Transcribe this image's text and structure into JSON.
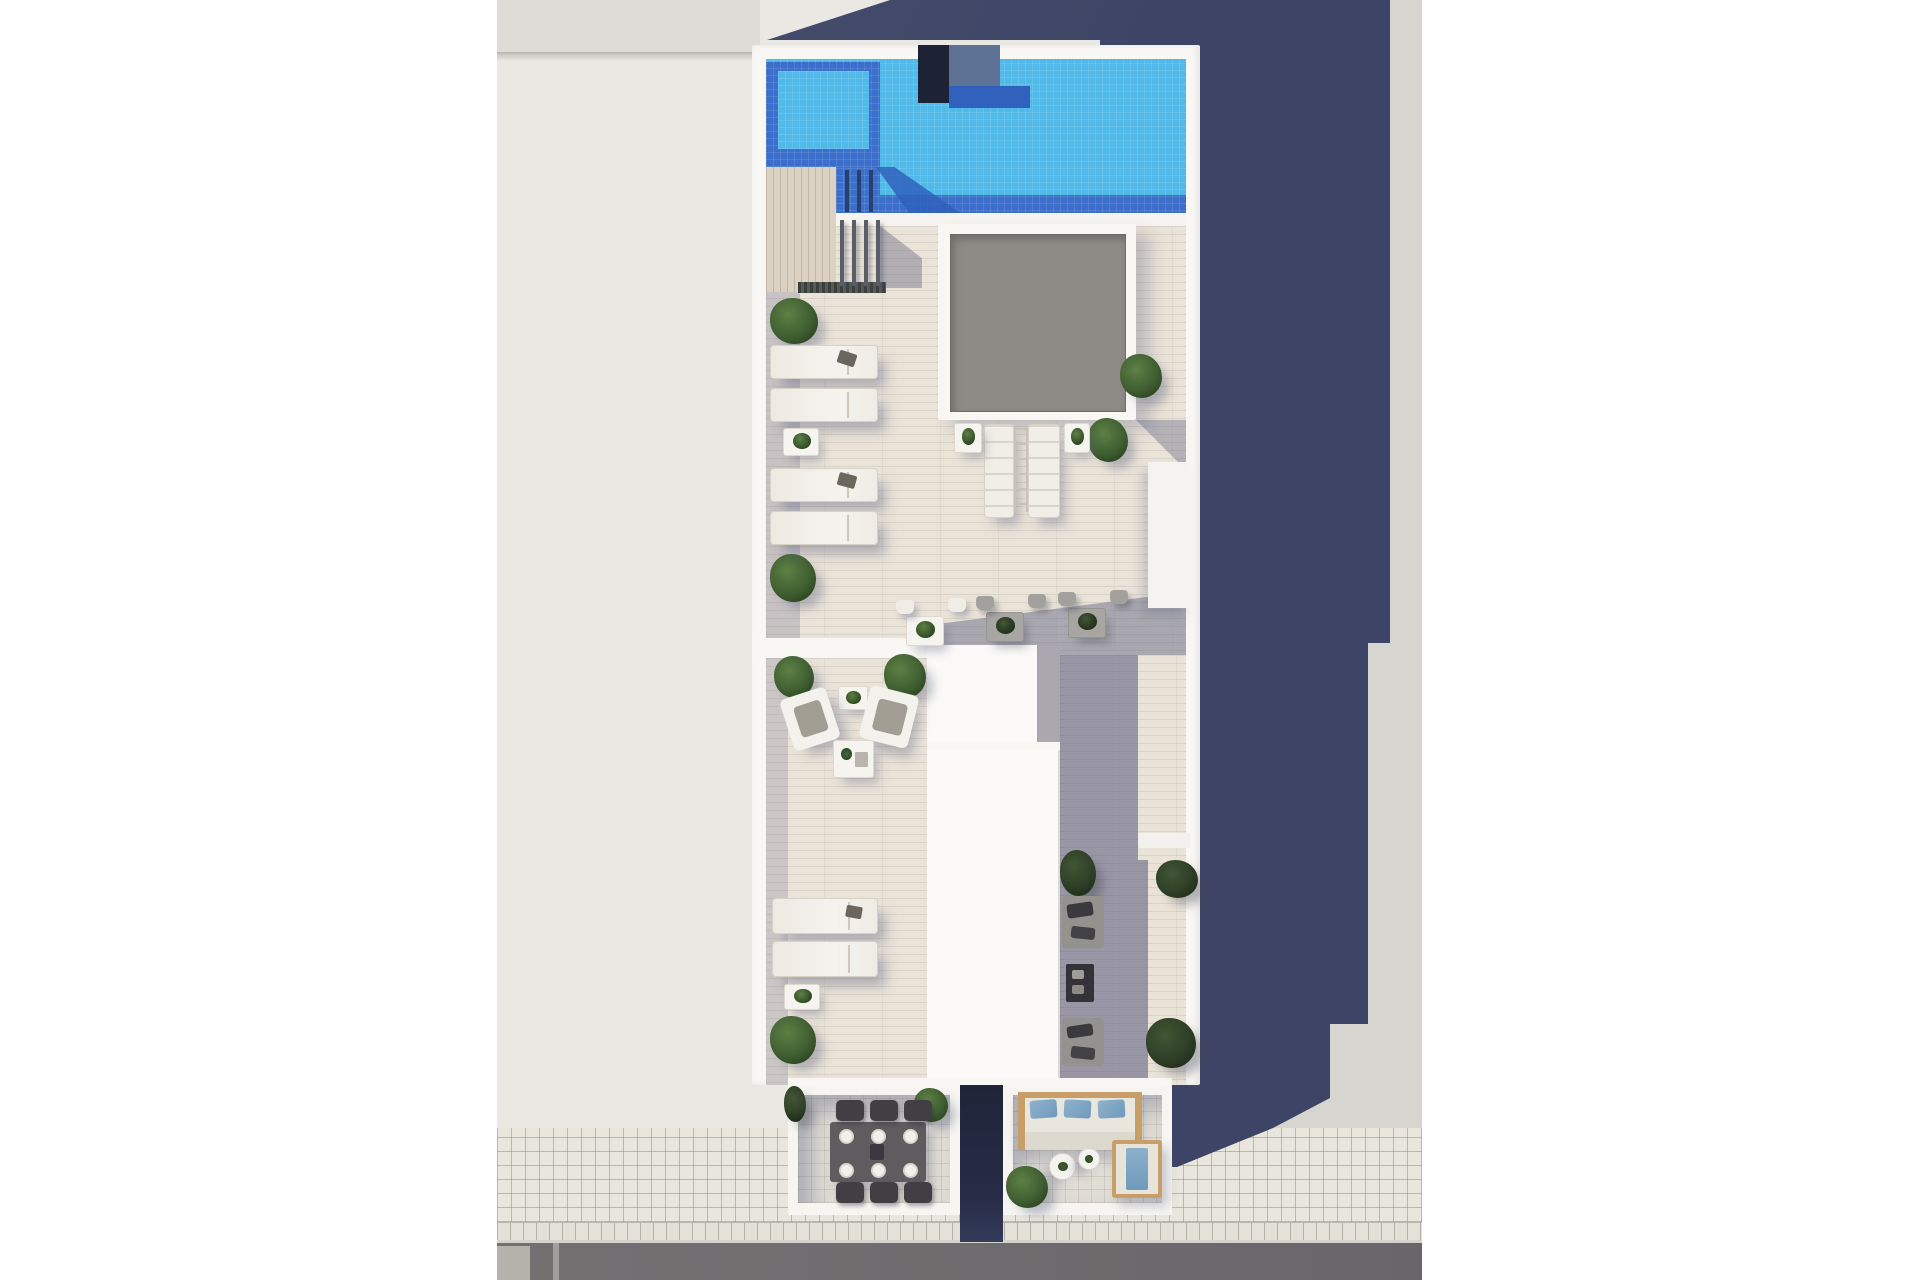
{
  "scene": {
    "type": "aerial-3d-render",
    "subject": "rooftop-terrace-floor-plan-with-pool",
    "areas": [
      {
        "name": "swimming-pool"
      },
      {
        "name": "sun-deck"
      },
      {
        "name": "skylight"
      },
      {
        "name": "mid-terrace-seating"
      },
      {
        "name": "shaded-lounge"
      },
      {
        "name": "dining-terrace"
      },
      {
        "name": "lounge-terrace"
      },
      {
        "name": "sidewalk"
      },
      {
        "name": "road"
      },
      {
        "name": "building-cast-shadow"
      }
    ],
    "items": [
      {
        "name": "pool-ladder-bar",
        "t": "pool-bar",
        "x": 845,
        "y": 170,
        "w": 4,
        "h": 42
      },
      {
        "name": "pool-ladder-bar",
        "t": "pool-bar",
        "x": 857,
        "y": 170,
        "w": 4,
        "h": 42
      },
      {
        "name": "pool-ladder-bar",
        "t": "pool-bar",
        "x": 869,
        "y": 170,
        "w": 4,
        "h": 42
      },
      {
        "name": "railing-post",
        "t": "post",
        "x": 840,
        "y": 220,
        "w": 4,
        "h": 66
      },
      {
        "name": "railing-post",
        "t": "post",
        "x": 852,
        "y": 220,
        "w": 4,
        "h": 66
      },
      {
        "name": "railing-post",
        "t": "post",
        "x": 864,
        "y": 220,
        "w": 4,
        "h": 66
      },
      {
        "name": "railing-post",
        "t": "post",
        "x": 876,
        "y": 220,
        "w": 4,
        "h": 66
      },
      {
        "name": "potted-plant",
        "t": "plant",
        "x": 770,
        "y": 298,
        "w": 48,
        "h": 46
      },
      {
        "name": "potted-plant",
        "t": "plant",
        "x": 770,
        "y": 554,
        "w": 46,
        "h": 48
      },
      {
        "name": "potted-plant",
        "t": "plant",
        "x": 1120,
        "y": 354,
        "w": 42,
        "h": 44
      },
      {
        "name": "potted-plant",
        "t": "plant",
        "x": 1088,
        "y": 418,
        "w": 40,
        "h": 44
      },
      {
        "name": "potted-plant",
        "t": "plant",
        "x": 774,
        "y": 656,
        "w": 40,
        "h": 42
      },
      {
        "name": "potted-plant",
        "t": "plant",
        "x": 884,
        "y": 654,
        "w": 42,
        "h": 44
      },
      {
        "name": "potted-plant",
        "t": "plant",
        "x": 770,
        "y": 1016,
        "w": 46,
        "h": 48
      },
      {
        "name": "potted-plant",
        "t": "plant",
        "x": 1060,
        "y": 850,
        "w": 36,
        "h": 46,
        "dim": true
      },
      {
        "name": "potted-plant",
        "t": "plant",
        "x": 1156,
        "y": 860,
        "w": 42,
        "h": 38,
        "dim": true
      },
      {
        "name": "potted-plant",
        "t": "plant",
        "x": 1146,
        "y": 1018,
        "w": 50,
        "h": 50,
        "dim": true
      },
      {
        "name": "potted-plant",
        "t": "plant",
        "x": 914,
        "y": 1088,
        "w": 34,
        "h": 34
      },
      {
        "name": "potted-plant",
        "t": "plant",
        "x": 784,
        "y": 1086,
        "w": 22,
        "h": 36,
        "dim": true
      },
      {
        "name": "potted-plant",
        "t": "plant",
        "x": 1006,
        "y": 1166,
        "w": 42,
        "h": 42
      },
      {
        "name": "sun-lounger",
        "t": "lounger-h",
        "x": 770,
        "y": 345,
        "w": 108,
        "h": 34
      },
      {
        "name": "sun-lounger",
        "t": "lounger-h",
        "x": 770,
        "y": 388,
        "w": 108,
        "h": 34
      },
      {
        "name": "sun-lounger",
        "t": "lounger-h",
        "x": 770,
        "y": 468,
        "w": 108,
        "h": 34
      },
      {
        "name": "sun-lounger",
        "t": "lounger-h",
        "x": 770,
        "y": 511,
        "w": 108,
        "h": 34
      },
      {
        "name": "sun-lounger",
        "t": "lounger-h",
        "x": 772,
        "y": 898,
        "w": 106,
        "h": 36
      },
      {
        "name": "sun-lounger",
        "t": "lounger-h",
        "x": 772,
        "y": 941,
        "w": 106,
        "h": 36
      },
      {
        "name": "towel",
        "t": "towel",
        "x": 838,
        "y": 352,
        "w": 18,
        "h": 13,
        "r": 18
      },
      {
        "name": "towel",
        "t": "towel",
        "x": 838,
        "y": 474,
        "w": 18,
        "h": 13,
        "r": 15
      },
      {
        "name": "towel",
        "t": "towel",
        "x": 846,
        "y": 906,
        "w": 16,
        "h": 12,
        "r": 10
      },
      {
        "name": "sun-lounger",
        "t": "lounger-v",
        "x": 984,
        "y": 424,
        "w": 30,
        "h": 94
      },
      {
        "name": "sun-lounger",
        "t": "lounger-v",
        "x": 1028,
        "y": 424,
        "w": 32,
        "h": 94
      },
      {
        "name": "lounger-frame",
        "t": "ladder",
        "x": 1014,
        "y": 428,
        "w": 14,
        "h": 84
      },
      {
        "name": "side-table",
        "t": "side-table",
        "x": 783,
        "y": 428,
        "w": 36,
        "h": 28
      },
      {
        "name": "side-table",
        "t": "side-table",
        "x": 954,
        "y": 423,
        "w": 28,
        "h": 30
      },
      {
        "name": "side-table",
        "t": "side-table",
        "x": 1064,
        "y": 423,
        "w": 26,
        "h": 30
      },
      {
        "name": "side-table",
        "t": "side-table",
        "x": 838,
        "y": 686,
        "w": 30,
        "h": 24
      },
      {
        "name": "side-table",
        "t": "side-table",
        "x": 784,
        "y": 984,
        "w": 36,
        "h": 26
      },
      {
        "name": "bistro-table",
        "t": "bistro-table",
        "x": 906,
        "y": 616,
        "w": 38,
        "h": 30
      },
      {
        "name": "bistro-table",
        "t": "bistro-table",
        "x": 986,
        "y": 612,
        "w": 38,
        "h": 30,
        "dim": true
      },
      {
        "name": "bistro-table",
        "t": "bistro-table",
        "x": 1068,
        "y": 608,
        "w": 38,
        "h": 30,
        "dim": true
      },
      {
        "name": "bistro-chair",
        "t": "chair-small",
        "x": 896,
        "y": 600,
        "w": 18,
        "h": 14
      },
      {
        "name": "bistro-chair",
        "t": "chair-small",
        "x": 948,
        "y": 598,
        "w": 18,
        "h": 14
      },
      {
        "name": "bistro-chair",
        "t": "chair-small",
        "x": 976,
        "y": 596,
        "w": 18,
        "h": 14,
        "dim": true
      },
      {
        "name": "bistro-chair",
        "t": "chair-small",
        "x": 1028,
        "y": 594,
        "w": 18,
        "h": 14,
        "dim": true
      },
      {
        "name": "bistro-chair",
        "t": "chair-small",
        "x": 1058,
        "y": 592,
        "w": 18,
        "h": 14,
        "dim": true
      },
      {
        "name": "bistro-chair",
        "t": "chair-small",
        "x": 1110,
        "y": 590,
        "w": 18,
        "h": 14,
        "dim": true
      },
      {
        "name": "armchair",
        "t": "armchair",
        "x": 786,
        "y": 692,
        "w": 48,
        "h": 54,
        "r": -18
      },
      {
        "name": "armchair",
        "t": "armchair",
        "x": 864,
        "y": 690,
        "w": 50,
        "h": 54,
        "r": 14
      },
      {
        "name": "coffee-table",
        "t": "coffee-white",
        "x": 833,
        "y": 740,
        "w": 41,
        "h": 38
      },
      {
        "name": "shaded-sofa",
        "t": "sofa-shaded",
        "x": 1062,
        "y": 896,
        "w": 42,
        "h": 52,
        "dim": true
      },
      {
        "name": "shaded-sofa",
        "t": "sofa-shaded",
        "x": 1062,
        "y": 1018,
        "w": 42,
        "h": 48,
        "dim": true
      },
      {
        "name": "coffee-table-dark",
        "t": "coffee-dark",
        "x": 1066,
        "y": 964,
        "w": 28,
        "h": 38,
        "dim": true
      },
      {
        "name": "dining-chair",
        "t": "chair-dark",
        "x": 836,
        "y": 1100,
        "w": 28,
        "h": 21
      },
      {
        "name": "dining-chair",
        "t": "chair-dark",
        "x": 870,
        "y": 1100,
        "w": 28,
        "h": 21
      },
      {
        "name": "dining-chair",
        "t": "chair-dark",
        "x": 904,
        "y": 1100,
        "w": 28,
        "h": 21
      },
      {
        "name": "dining-chair",
        "t": "chair-dark",
        "x": 836,
        "y": 1182,
        "w": 28,
        "h": 21
      },
      {
        "name": "dining-chair",
        "t": "chair-dark",
        "x": 870,
        "y": 1182,
        "w": 28,
        "h": 21
      },
      {
        "name": "dining-chair",
        "t": "chair-dark",
        "x": 904,
        "y": 1182,
        "w": 28,
        "h": 21
      },
      {
        "name": "place-setting",
        "t": "plate",
        "x": 839,
        "y": 1129,
        "w": 15,
        "h": 15
      },
      {
        "name": "place-setting",
        "t": "plate",
        "x": 871,
        "y": 1129,
        "w": 15,
        "h": 15
      },
      {
        "name": "place-setting",
        "t": "plate",
        "x": 903,
        "y": 1129,
        "w": 15,
        "h": 15
      },
      {
        "name": "place-setting",
        "t": "plate",
        "x": 839,
        "y": 1163,
        "w": 15,
        "h": 15
      },
      {
        "name": "place-setting",
        "t": "plate",
        "x": 871,
        "y": 1163,
        "w": 15,
        "h": 15
      },
      {
        "name": "place-setting",
        "t": "plate",
        "x": 903,
        "y": 1163,
        "w": 15,
        "h": 15
      },
      {
        "name": "sofa-pillow",
        "t": "pillow",
        "x": 1030,
        "y": 1100,
        "w": 27,
        "h": 18,
        "r": -4
      },
      {
        "name": "sofa-pillow",
        "t": "pillow",
        "x": 1064,
        "y": 1100,
        "w": 27,
        "h": 18,
        "r": 3
      },
      {
        "name": "sofa-pillow",
        "t": "pillow",
        "x": 1098,
        "y": 1100,
        "w": 27,
        "h": 18,
        "r": -3
      },
      {
        "name": "round-table",
        "t": "round-table",
        "x": 1049,
        "y": 1153,
        "w": 27,
        "h": 27
      },
      {
        "name": "round-table",
        "t": "round-table",
        "x": 1078,
        "y": 1148,
        "w": 22,
        "h": 22
      }
    ]
  },
  "palette": {
    "bg_white": "#ffffff",
    "roof_left": "#eae8e2",
    "roof_left_top": "#dedcd6",
    "ground_right": "#d7d5d0",
    "sidewalk": "#e9e7dd",
    "road": "#6f6c6e",
    "road_panel": "#b5b2ab",
    "shadow_navy": "#3e4465",
    "shadow_navy_light": "#4a5070",
    "wall_white": "#f8f7f4",
    "pool_light": "#52bae9",
    "pool_dark": "#3b6fcb",
    "pool_deep": "#3061bc",
    "pool_block_navy": "#1d2234",
    "pool_block_gray": "#5e7296",
    "deck_wood": "#eae3d8",
    "wood_vertical": "#dbd2c4",
    "skylight_gray": "#8e8b86",
    "floor_unit": "#e0ddd5",
    "void_dark": "#232842",
    "wood_tan": "#c89f69",
    "plant_dark": "#2c4520",
    "plant_mid": "#3f5e31",
    "plant_light": "#5d8045"
  }
}
